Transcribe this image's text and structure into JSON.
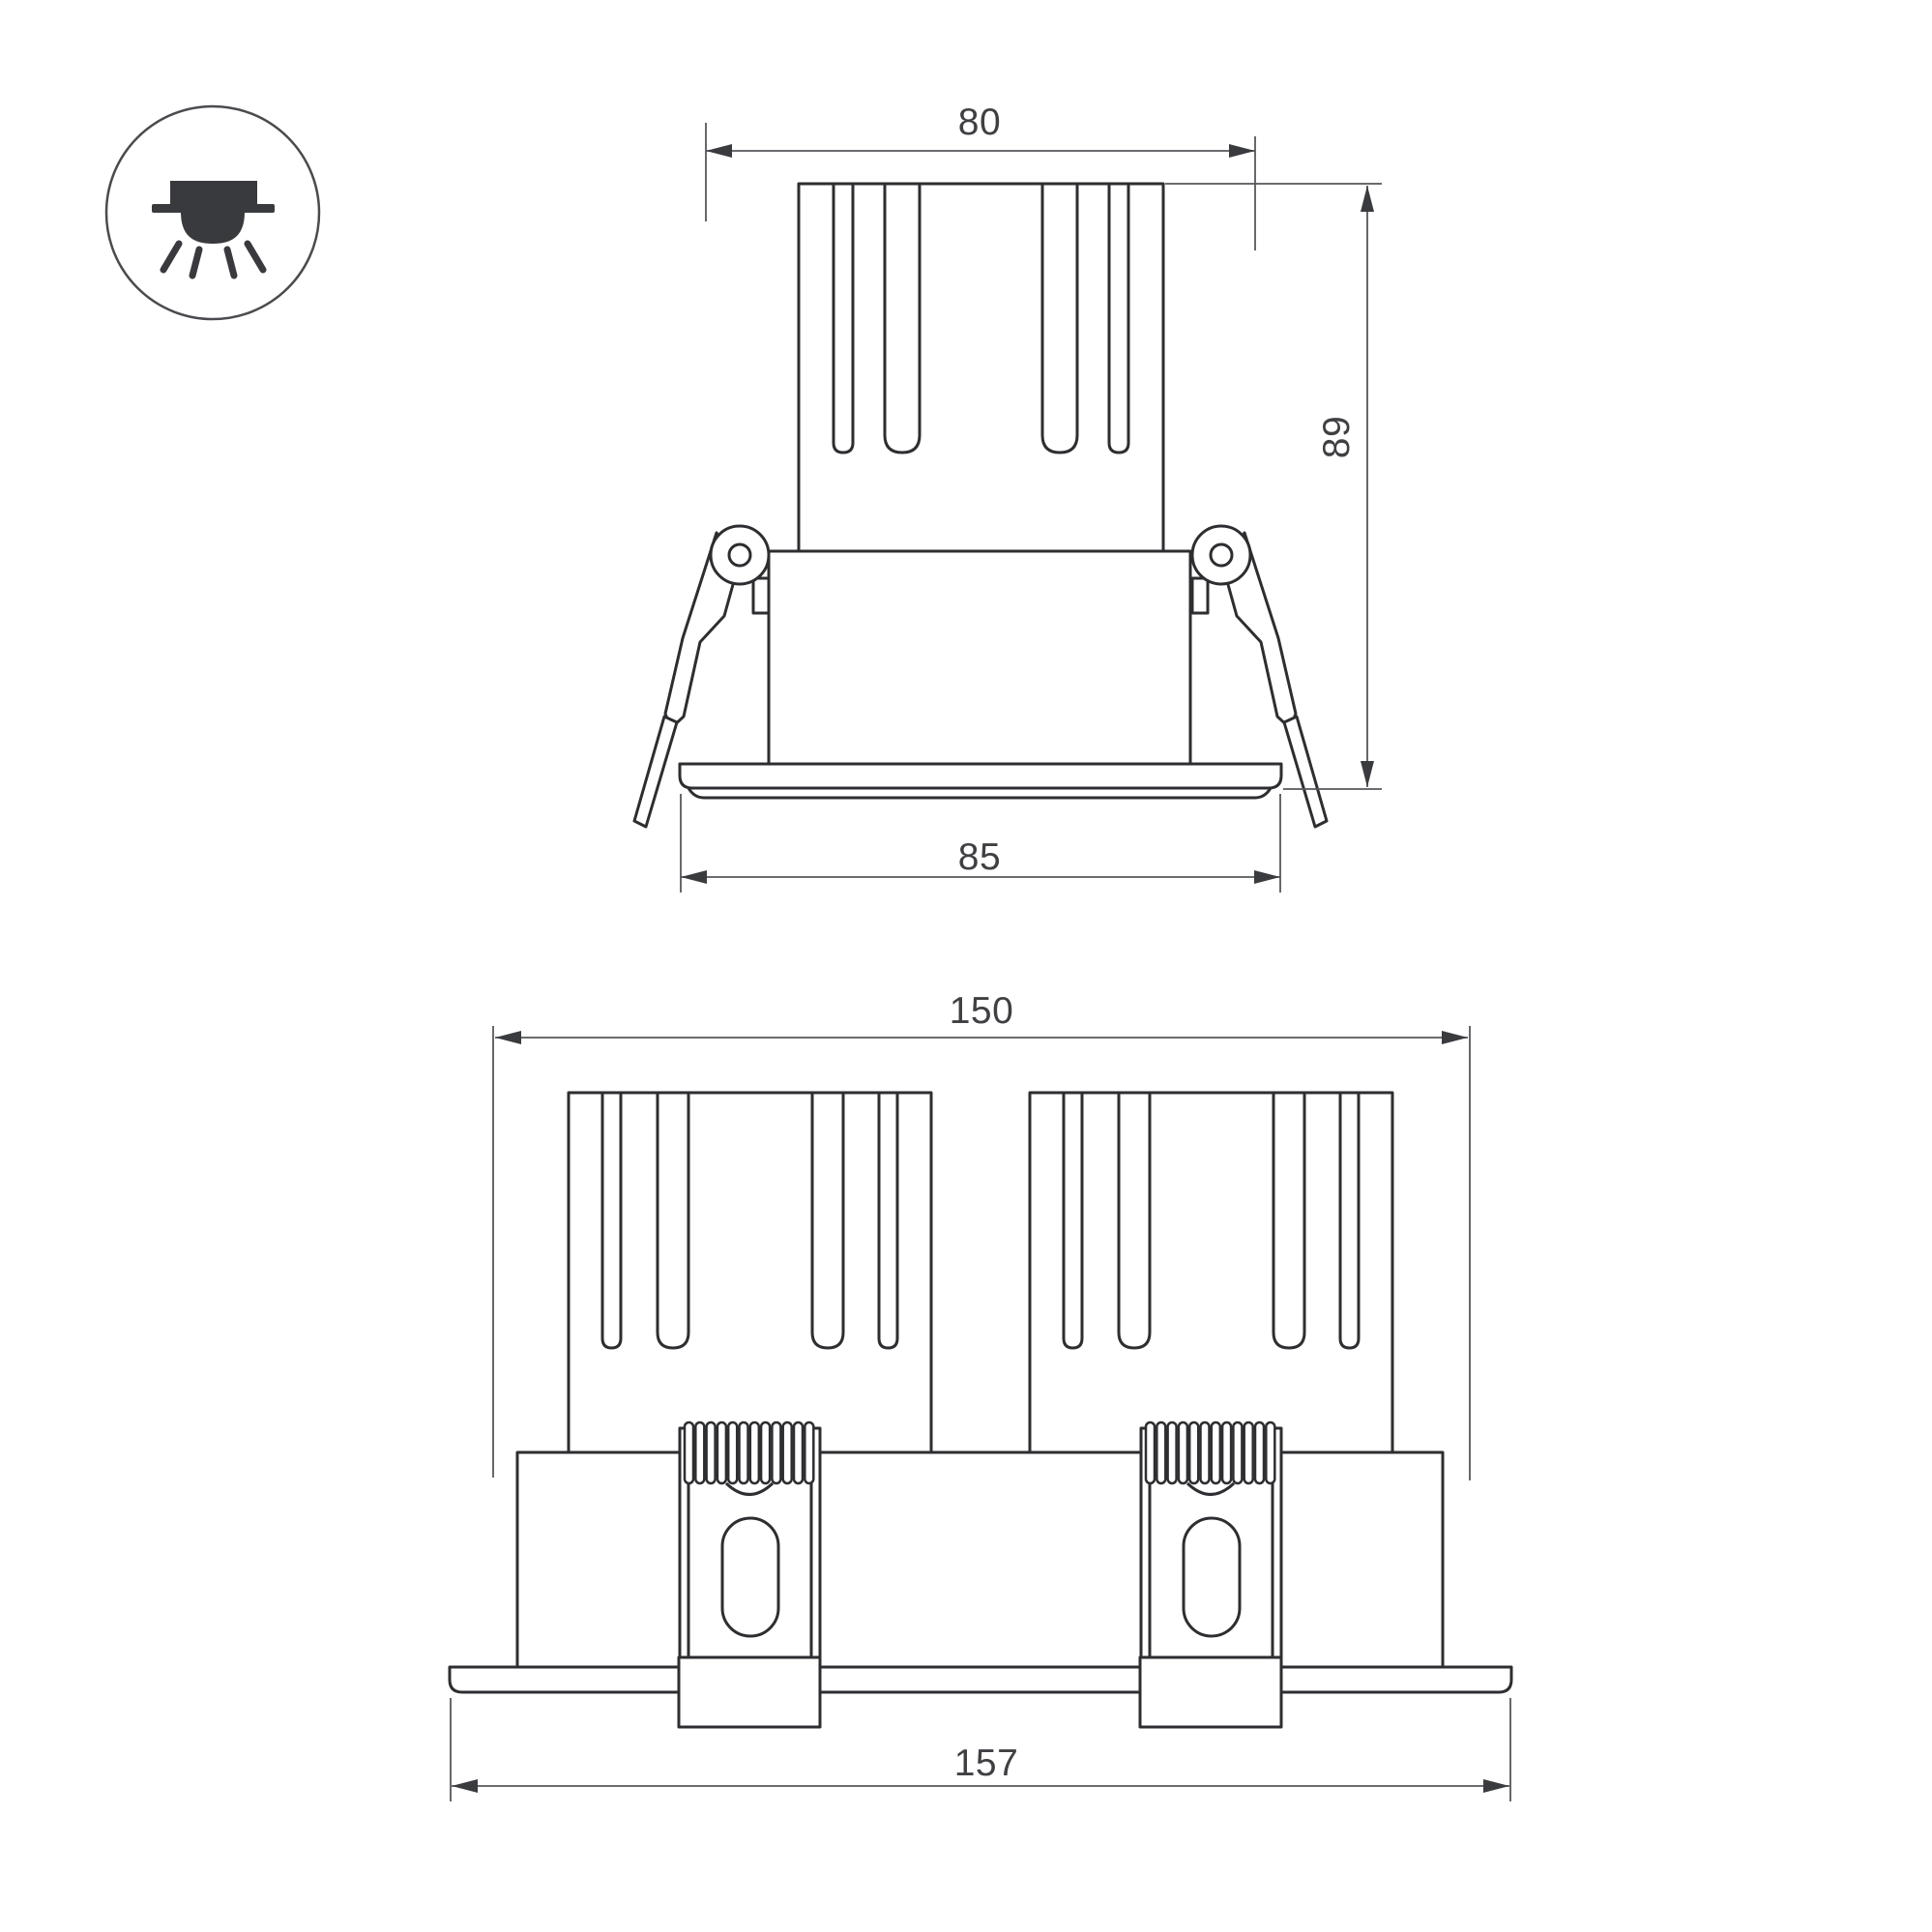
{
  "drawing": {
    "type": "dimensional line drawing of recessed downlight luminaire",
    "units": "mm",
    "views": {
      "single": {
        "label": "single module front view",
        "dims": {
          "top_width": "80",
          "height": "89",
          "flange_width": "85"
        }
      },
      "double": {
        "label": "double module front view",
        "dims": {
          "top_width": "150",
          "flange_width": "157"
        }
      }
    },
    "icon": {
      "name": "recessed-downlight-icon"
    },
    "colors": {
      "background": "#ffffff",
      "object_line": "#2d2e31",
      "dimension_line": "#56575c",
      "text": "#3f4043",
      "icon": "#393a3e"
    }
  }
}
